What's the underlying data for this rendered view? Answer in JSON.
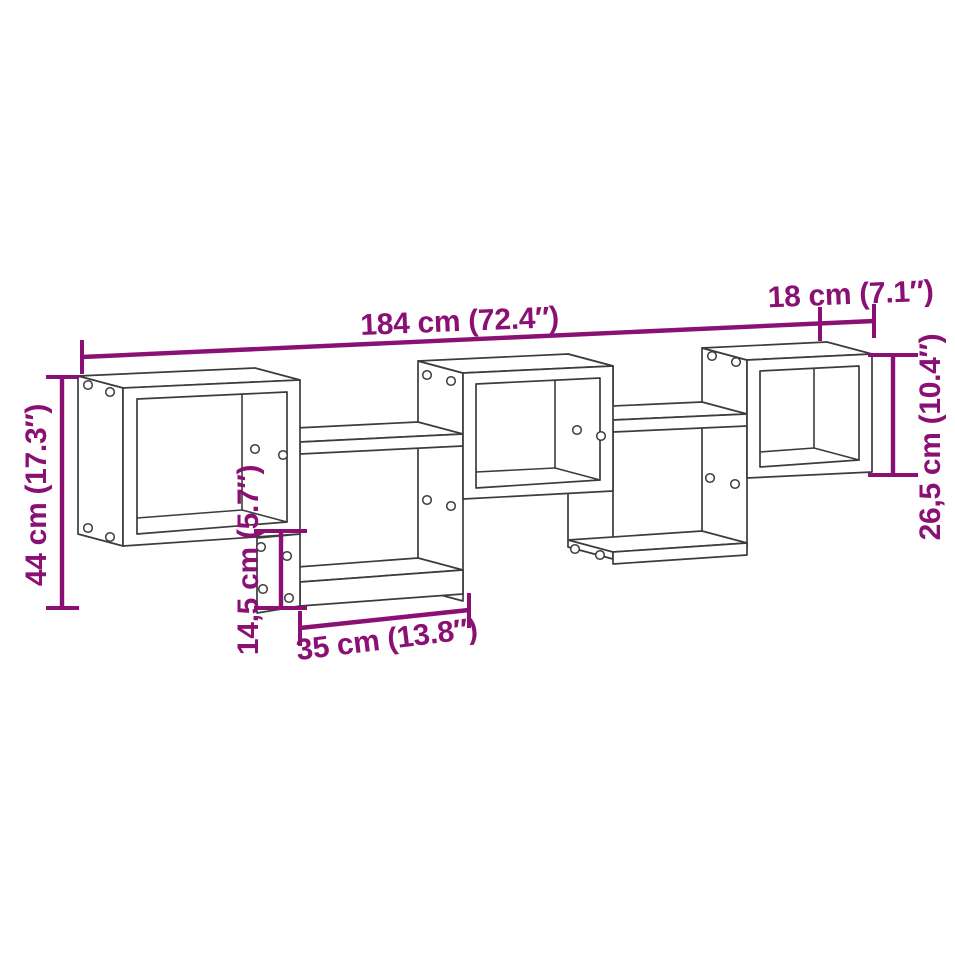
{
  "page": {
    "title": "Wall cube shelf dimension diagram"
  },
  "colors": {
    "accent": "#8a1173",
    "line": "#3c3c3c",
    "page_bg": "#ffffff"
  },
  "diagram": {
    "type": "product-dimension-drawing",
    "subject": "wall-mounted cube shelf with five staggered compartments",
    "labels": {
      "total_width": "184 cm (72.4″)",
      "depth": "18 cm (7.1″)",
      "total_height": "44 cm (17.3″)",
      "cube_height": "26,5 cm (10.4″)",
      "drop_height": "14,5 cm (5.7″)",
      "compartment_width": "35 cm (13.8″)"
    }
  }
}
